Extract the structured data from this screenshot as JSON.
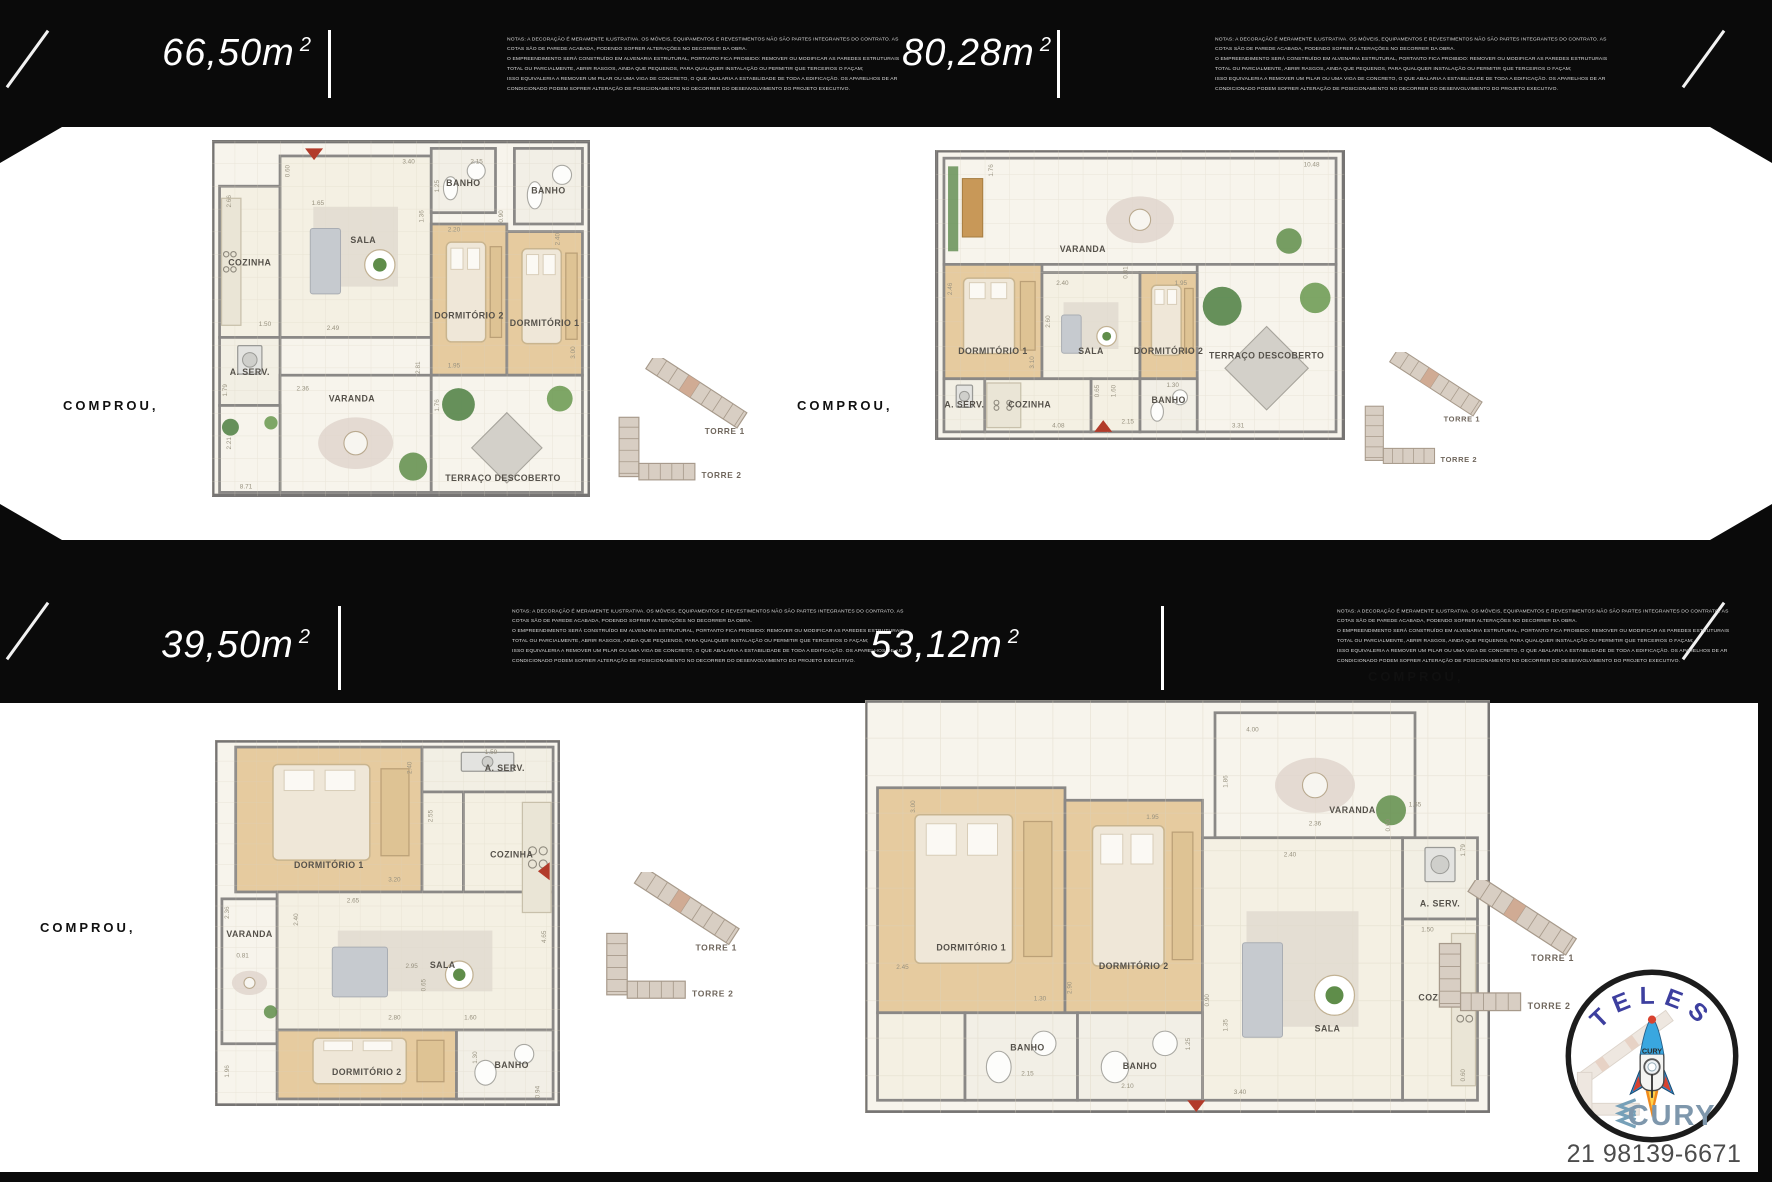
{
  "compra": "COMPROU,",
  "panels": [
    {
      "area": "66,50m",
      "area_sup": "2"
    },
    {
      "area": "80,28m",
      "area_sup": "2"
    },
    {
      "area": "39,50m",
      "area_sup": "2"
    },
    {
      "area": "53,12m",
      "area_sup": "2"
    }
  ],
  "notes_lines": [
    "NOTAS: A DECORAÇÃO É MERAMENTE ILUSTRATIVA. OS MÓVEIS, EQUIPAMENTOS E REVESTIMENTOS NÃO SÃO PARTES INTEGRANTES DO CONTRATO. AS",
    "COTAS SÃO DE PAREDE ACABADA, PODENDO SOFRER ALTERAÇÕES NO DECORRER DA OBRA.",
    "O EMPREENDIMENTO SERÁ CONSTRUÍDO EM ALVENARIA ESTRUTURAL, PORTANTO FICA PROIBIDO: REMOVER OU MODIFICAR AS PAREDES ESTRUTURAIS",
    "TOTAL OU PARCIALMENTE, ABRIR RASGOS, AINDA QUE PEQUENOS, PARA QUALQUER INSTALAÇÃO OU PERMITIR QUE TERCEIROS O FAÇAM;",
    "ISSO EQUIVALERIA A REMOVER UM PILAR OU UMA VIGA DE CONCRETO, O QUE ABALARIA A ESTABILIDADE DE TODA A EDIFICAÇÃO. OS APARELHOS DE AR",
    "CONDICIONADO PODEM SOFRER ALTERAÇÃO DE POSICIONAMENTO NO DECORRER DO DESENVOLVIMENTO DO PROJETO EXECUTIVO."
  ],
  "keyplan_labels": {
    "torre1": "TORRE 1",
    "torre2": "TORRE 2"
  },
  "logo": {
    "top": "TELES",
    "bottom": "CURY",
    "rocket_label": "CURY",
    "phone": "21 98139-6671"
  },
  "colors": {
    "banner": "#0a0a0a",
    "accent_red": "#b23b2a",
    "wall": "#7a7875",
    "wood": "#e6cb9f",
    "tile": "#f4f0e3",
    "open": "#f7f4ec",
    "keyplan_fill": "#d8cec3",
    "keyplan_stroke": "#a79a8b",
    "keyplan_unit": "#cfa58c",
    "room_label": "#55514a",
    "dim_label": "#97917f",
    "brand_blue": "#3d3f9f",
    "brand_gray_blue": "#7e97ac",
    "phone_color": "#4c4c4c"
  },
  "plans": [
    {
      "name": "66,50m2",
      "w": 378,
      "vb": 94,
      "rooms": [
        {
          "label": "COZINHA",
          "kind": "cozinha",
          "x": 2,
          "y": 12,
          "w": 16,
          "h": 40,
          "lx": 10,
          "ly": 33
        },
        {
          "label": "A. SERV.",
          "kind": "aserv",
          "x": 2,
          "y": 52,
          "w": 16,
          "h": 18,
          "lx": 10,
          "ly": 62
        },
        {
          "label": "SALA",
          "kind": "sala",
          "x": 18,
          "y": 4,
          "w": 40,
          "h": 48,
          "lx": 40,
          "ly": 27
        },
        {
          "label": "BANHO",
          "kind": "banho",
          "x": 58,
          "y": 2,
          "w": 17,
          "h": 17,
          "lx": 66.5,
          "ly": 12
        },
        {
          "label": "BANHO",
          "kind": "banho",
          "x": 80,
          "y": 2,
          "w": 18,
          "h": 20,
          "lx": 89,
          "ly": 14
        },
        {
          "label": "DORMITÓRIO 2",
          "kind": "wood",
          "x": 58,
          "y": 22,
          "w": 20,
          "h": 40,
          "lx": 68,
          "ly": 47
        },
        {
          "label": "DORMITÓRIO 1",
          "kind": "wood",
          "x": 78,
          "y": 24,
          "w": 20,
          "h": 38,
          "lx": 88,
          "ly": 49
        },
        {
          "label": "VARANDA",
          "kind": "varanda",
          "x": 18,
          "y": 62,
          "w": 40,
          "h": 31,
          "lx": 37,
          "ly": 69
        },
        {
          "label": "",
          "kind": "terraco",
          "x": 2,
          "y": 70,
          "w": 16,
          "h": 23
        },
        {
          "label": "TERRAÇO DESCOBERTO",
          "kind": "terraco",
          "x": 58,
          "y": 62,
          "w": 40,
          "h": 31,
          "lx": 77,
          "ly": 90
        }
      ],
      "dims": [
        {
          "t": "0.60",
          "x": 20.5,
          "y": 8,
          "r": 1
        },
        {
          "t": "1.65",
          "x": 28,
          "y": 17
        },
        {
          "t": "2.66",
          "x": 5,
          "y": 16,
          "r": 1
        },
        {
          "t": "3.40",
          "x": 52,
          "y": 6
        },
        {
          "t": "2.15",
          "x": 70,
          "y": 6
        },
        {
          "t": "1.25",
          "x": 60,
          "y": 12,
          "r": 1
        },
        {
          "t": "1.36",
          "x": 56,
          "y": 20,
          "r": 1
        },
        {
          "t": "2.20",
          "x": 64,
          "y": 24
        },
        {
          "t": "0.90",
          "x": 77,
          "y": 20,
          "r": 1
        },
        {
          "t": "2.40",
          "x": 92,
          "y": 26,
          "r": 1
        },
        {
          "t": "1.50",
          "x": 14,
          "y": 49
        },
        {
          "t": "2.49",
          "x": 32,
          "y": 50
        },
        {
          "t": "2.36",
          "x": 24,
          "y": 66
        },
        {
          "t": "1.79",
          "x": 4,
          "y": 66,
          "r": 1
        },
        {
          "t": "2.81",
          "x": 55,
          "y": 60,
          "r": 1
        },
        {
          "t": "1.95",
          "x": 64,
          "y": 60
        },
        {
          "t": "3.00",
          "x": 96,
          "y": 56,
          "r": 1
        },
        {
          "t": "1.76",
          "x": 60,
          "y": 70,
          "r": 1
        },
        {
          "t": "2.21",
          "x": 5,
          "y": 80,
          "r": 1
        },
        {
          "t": "8.71",
          "x": 9,
          "y": 92
        }
      ],
      "arrow": {
        "x": 27,
        "y": 2,
        "dir": "down"
      }
    },
    {
      "name": "80,28m2",
      "w": 410,
      "vb": 71,
      "rooms": [
        {
          "label": "VARANDA",
          "kind": "varanda",
          "x": 2,
          "y": 2,
          "w": 96,
          "h": 26,
          "lx": 36,
          "ly": 25
        },
        {
          "label": "TERRAÇO DESCOBERTO",
          "kind": "terraco",
          "x": 64,
          "y": 28,
          "w": 34,
          "h": 41,
          "lx": 81,
          "ly": 51
        },
        {
          "label": "DORMITÓRIO 1",
          "kind": "wood",
          "x": 2,
          "y": 28,
          "w": 24,
          "h": 28,
          "lx": 14,
          "ly": 50
        },
        {
          "label": "SALA",
          "kind": "sala",
          "x": 26,
          "y": 30,
          "w": 24,
          "h": 26,
          "lx": 38,
          "ly": 50
        },
        {
          "label": "DORMITÓRIO 2",
          "kind": "wood",
          "x": 50,
          "y": 30,
          "w": 14,
          "h": 26,
          "lx": 57,
          "ly": 50
        },
        {
          "label": "A. SERV.",
          "kind": "aserv",
          "x": 2,
          "y": 56,
          "w": 10,
          "h": 13,
          "lx": 7,
          "ly": 63
        },
        {
          "label": "",
          "kind": "tile",
          "x": 38,
          "y": 56,
          "w": 12,
          "h": 13
        },
        {
          "label": "COZINHA",
          "kind": "cozinha",
          "x": 12,
          "y": 56,
          "w": 26,
          "h": 13,
          "lx": 23,
          "ly": 63
        },
        {
          "label": "BANHO",
          "kind": "banho",
          "x": 50,
          "y": 56,
          "w": 14,
          "h": 13,
          "lx": 57,
          "ly": 62
        }
      ],
      "dims": [
        {
          "t": "10.48",
          "x": 92,
          "y": 4
        },
        {
          "t": "1.76",
          "x": 14,
          "y": 5,
          "r": 1
        },
        {
          "t": "0.81",
          "x": 47,
          "y": 30,
          "r": 1
        },
        {
          "t": "2.46",
          "x": 4,
          "y": 34,
          "r": 1
        },
        {
          "t": "2.40",
          "x": 31,
          "y": 33
        },
        {
          "t": "2.60",
          "x": 28,
          "y": 42,
          "r": 1
        },
        {
          "t": "1.95",
          "x": 60,
          "y": 33
        },
        {
          "t": "3.10",
          "x": 24,
          "y": 52,
          "r": 1
        },
        {
          "t": "0.65",
          "x": 40,
          "y": 59,
          "r": 1
        },
        {
          "t": "1.60",
          "x": 44,
          "y": 59,
          "r": 1
        },
        {
          "t": "1.30",
          "x": 58,
          "y": 58
        },
        {
          "t": "2.15",
          "x": 47,
          "y": 67
        },
        {
          "t": "4.08",
          "x": 30,
          "y": 68
        },
        {
          "t": "3.31",
          "x": 74,
          "y": 68
        }
      ],
      "arrow": {
        "x": 41,
        "y": 69,
        "dir": "up"
      }
    },
    {
      "name": "39,50m2",
      "w": 345,
      "vb": 106,
      "rooms": [
        {
          "label": "DORMITÓRIO 1",
          "kind": "wood",
          "x": 6,
          "y": 2,
          "w": 54,
          "h": 42,
          "lx": 33,
          "ly": 37
        },
        {
          "label": "A. SERV.",
          "kind": "aserv",
          "x": 60,
          "y": 2,
          "w": 38,
          "h": 13,
          "lx": 84,
          "ly": 9
        },
        {
          "label": "",
          "kind": "tile",
          "x": 60,
          "y": 15,
          "w": 12,
          "h": 38
        },
        {
          "label": "COZINHA",
          "kind": "cozinha",
          "x": 72,
          "y": 15,
          "w": 26,
          "h": 38,
          "lx": 86,
          "ly": 34
        },
        {
          "label": "VARANDA",
          "kind": "varanda",
          "x": 2,
          "y": 46,
          "w": 16,
          "h": 42,
          "lx": 10,
          "ly": 57
        },
        {
          "label": "SALA",
          "kind": "sala",
          "x": 18,
          "y": 44,
          "w": 80,
          "h": 40,
          "lx": 66,
          "ly": 66
        },
        {
          "label": "DORMITÓRIO 2",
          "kind": "wood",
          "x": 18,
          "y": 84,
          "w": 52,
          "h": 20,
          "lx": 44,
          "ly": 97
        },
        {
          "label": "BANHO",
          "kind": "banho",
          "x": 70,
          "y": 84,
          "w": 28,
          "h": 20,
          "lx": 86,
          "ly": 95
        }
      ],
      "dims": [
        {
          "t": "2.40",
          "x": 57,
          "y": 8,
          "r": 1
        },
        {
          "t": "1.59",
          "x": 80,
          "y": 4
        },
        {
          "t": "2.55",
          "x": 63,
          "y": 22,
          "r": 1
        },
        {
          "t": "3.20",
          "x": 52,
          "y": 41
        },
        {
          "t": "2.65",
          "x": 40,
          "y": 47
        },
        {
          "t": "2.36",
          "x": 4,
          "y": 50,
          "r": 1
        },
        {
          "t": "2.40",
          "x": 24,
          "y": 52,
          "r": 1
        },
        {
          "t": "0.81",
          "x": 8,
          "y": 63
        },
        {
          "t": "4.65",
          "x": 96,
          "y": 57,
          "r": 1
        },
        {
          "t": "2.95",
          "x": 57,
          "y": 66
        },
        {
          "t": "0.65",
          "x": 61,
          "y": 71,
          "r": 1
        },
        {
          "t": "2.80",
          "x": 52,
          "y": 81
        },
        {
          "t": "1.60",
          "x": 74,
          "y": 81
        },
        {
          "t": "1.30",
          "x": 76,
          "y": 92,
          "r": 1
        },
        {
          "t": "1.96",
          "x": 4,
          "y": 96,
          "r": 1
        },
        {
          "t": "0.94",
          "x": 94,
          "y": 102,
          "r": 1
        }
      ],
      "arrow": {
        "x": 97,
        "y": 38,
        "dir": "left"
      }
    },
    {
      "name": "53,12m2",
      "w": 625,
      "vb": 66,
      "rooms": [
        {
          "label": "DORMITÓRIO 1",
          "kind": "wood",
          "x": 2,
          "y": 14,
          "w": 30,
          "h": 36,
          "lx": 17,
          "ly": 40
        },
        {
          "label": "DORMITÓRIO 2",
          "kind": "wood",
          "x": 32,
          "y": 16,
          "w": 22,
          "h": 34,
          "lx": 43,
          "ly": 43
        },
        {
          "label": "VARANDA",
          "kind": "varanda",
          "x": 56,
          "y": 2,
          "w": 32,
          "h": 20,
          "lx": 78,
          "ly": 18
        },
        {
          "label": "A. SERV.",
          "kind": "aserv",
          "x": 86,
          "y": 22,
          "w": 12,
          "h": 13,
          "lx": 92,
          "ly": 33
        },
        {
          "label": "COZINHA",
          "kind": "cozinha",
          "x": 86,
          "y": 35,
          "w": 12,
          "h": 29,
          "lx": 92,
          "ly": 48
        },
        {
          "label": "SALA",
          "kind": "sala",
          "x": 54,
          "y": 22,
          "w": 32,
          "h": 42,
          "lx": 74,
          "ly": 53
        },
        {
          "label": "",
          "kind": "tile",
          "x": 2,
          "y": 50,
          "w": 14,
          "h": 14
        },
        {
          "label": "BANHO",
          "kind": "banho",
          "x": 16,
          "y": 50,
          "w": 18,
          "h": 14,
          "lx": 26,
          "ly": 56
        },
        {
          "label": "BANHO",
          "kind": "banho",
          "x": 34,
          "y": 50,
          "w": 20,
          "h": 14,
          "lx": 44,
          "ly": 59
        }
      ],
      "dims": [
        {
          "t": "3.00",
          "x": 8,
          "y": 17,
          "r": 1
        },
        {
          "t": "1.95",
          "x": 46,
          "y": 19
        },
        {
          "t": "4.00",
          "x": 62,
          "y": 5
        },
        {
          "t": "1.86",
          "x": 58,
          "y": 13,
          "r": 1
        },
        {
          "t": "2.36",
          "x": 72,
          "y": 20
        },
        {
          "t": "1.65",
          "x": 88,
          "y": 17
        },
        {
          "t": "0.60",
          "x": 84,
          "y": 20,
          "r": 1
        },
        {
          "t": "1.79",
          "x": 96,
          "y": 24,
          "r": 1
        },
        {
          "t": "2.40",
          "x": 68,
          "y": 25
        },
        {
          "t": "1.50",
          "x": 90,
          "y": 37
        },
        {
          "t": "2.45",
          "x": 6,
          "y": 43
        },
        {
          "t": "1.30",
          "x": 28,
          "y": 48
        },
        {
          "t": "2.90",
          "x": 33,
          "y": 46,
          "r": 1
        },
        {
          "t": "2.10",
          "x": 42,
          "y": 62
        },
        {
          "t": "0.90",
          "x": 55,
          "y": 48,
          "r": 1
        },
        {
          "t": "1.35",
          "x": 58,
          "y": 52,
          "r": 1
        },
        {
          "t": "1.25",
          "x": 52,
          "y": 55,
          "r": 1
        },
        {
          "t": "2.15",
          "x": 26,
          "y": 60
        },
        {
          "t": "3.40",
          "x": 60,
          "y": 63
        },
        {
          "t": "0.60",
          "x": 96,
          "y": 60,
          "r": 1
        }
      ],
      "arrow": {
        "x": 53,
        "y": 64,
        "dir": "down"
      }
    }
  ]
}
